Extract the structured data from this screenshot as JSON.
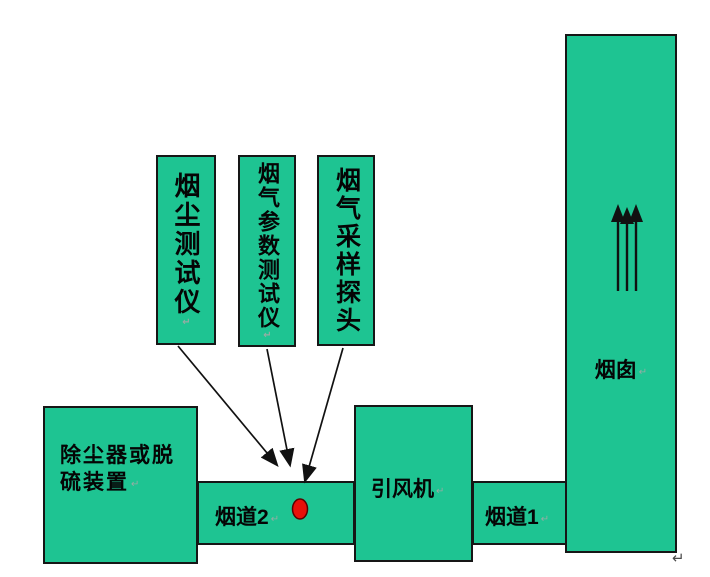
{
  "page": {
    "background": "#ffffff",
    "trailing_return_mark": "↵"
  },
  "colors": {
    "box_fill": "#1ec492",
    "box_border": "#161616",
    "arrow": "#111111",
    "sampling_dot_fill": "#e8110a",
    "sampling_dot_stroke": "#5a0000",
    "label_text": "#050505",
    "paragraph_mark": "#96aca4"
  },
  "return_mark": "↵",
  "instruments": [
    {
      "label": "烟尘测试仪"
    },
    {
      "label": "烟气参数测试仪"
    },
    {
      "label": "烟气采样探头"
    }
  ],
  "dust_remover": {
    "line1": "除尘器或脱",
    "line2": "硫装置"
  },
  "duct2": {
    "label": "烟道2"
  },
  "fan": {
    "label": "引风机"
  },
  "duct1": {
    "label": "烟道1"
  },
  "chimney": {
    "label": "烟囱"
  }
}
